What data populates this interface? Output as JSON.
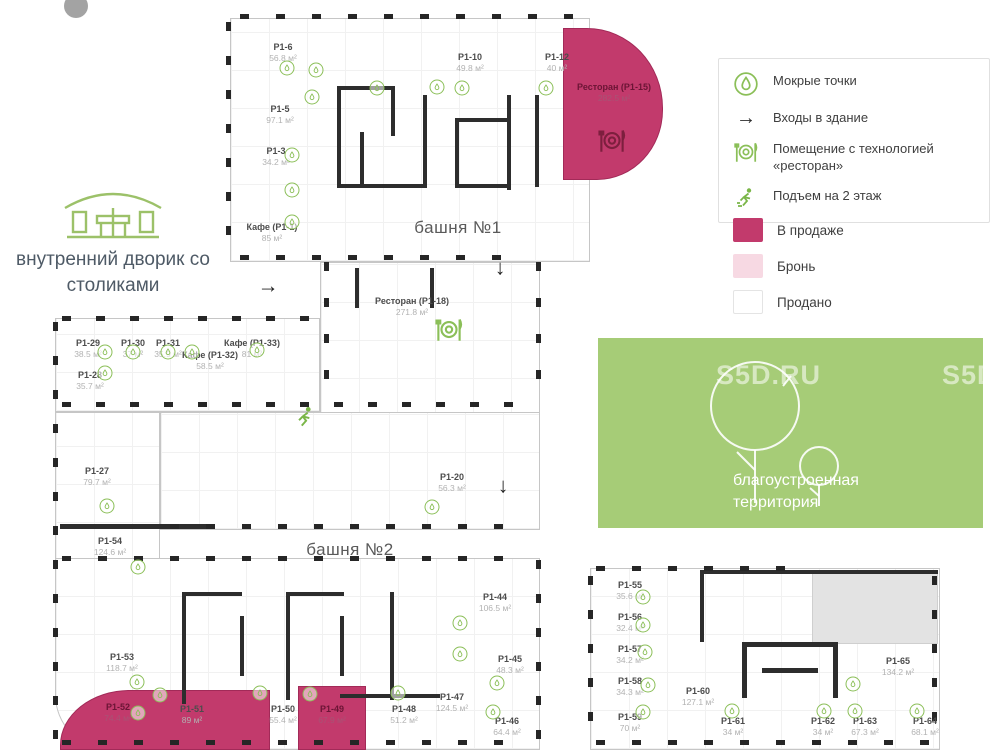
{
  "legend": {
    "items": [
      {
        "icon": "wet-point-icon",
        "label": "Мокрые точки"
      },
      {
        "icon": "entrance-arrow-icon",
        "label": "Входы в здание"
      },
      {
        "icon": "restaurant-icon",
        "label": "Помещение с технологией «ресторан»"
      },
      {
        "icon": "stairs-runner-icon",
        "label": "Подъем на 2 этаж"
      }
    ],
    "statuses": [
      {
        "label": "В продаже",
        "color": "#c23a6c"
      },
      {
        "label": "Бронь",
        "color": "#f7d9e3"
      },
      {
        "label": "Продано",
        "color": "#ffffff"
      }
    ]
  },
  "plan": {
    "tower1_label": "башня №1",
    "tower2_label": "башня №2",
    "courtyard_label": "внутренний дворик со столиками",
    "green_area_label": "благоустроенная территория",
    "watermark": "S5D.RU",
    "accent_green": "#8bbf58",
    "rooms": [
      {
        "name": "P1-6",
        "area": "56.8 м²",
        "x": 283,
        "y": 42
      },
      {
        "name": "P1-5",
        "area": "97.1 м²",
        "x": 280,
        "y": 104
      },
      {
        "name": "P1-3",
        "area": "34.2 м²",
        "x": 276,
        "y": 146
      },
      {
        "name": "Кафе (P1-1)",
        "area": "85 м²",
        "x": 272,
        "y": 222
      },
      {
        "name": "P1-10",
        "area": "49.8 м²",
        "x": 470,
        "y": 52
      },
      {
        "name": "P1-12",
        "area": "40 м²",
        "x": 557,
        "y": 52
      },
      {
        "name": "Ресторан (P1-15)",
        "area": "282.5 м²",
        "x": 614,
        "y": 82,
        "status": "sale"
      },
      {
        "name": "Ресторан (P1-18)",
        "area": "271.8 м²",
        "x": 412,
        "y": 296
      },
      {
        "name": "P1-29",
        "area": "38.5 м²",
        "x": 88,
        "y": 338
      },
      {
        "name": "P1-30",
        "area": "37 м²",
        "x": 133,
        "y": 338
      },
      {
        "name": "P1-31",
        "area": "35.9 м²",
        "x": 168,
        "y": 338
      },
      {
        "name": "Кафе (P1-32)",
        "area": "58.5 м²",
        "x": 210,
        "y": 350
      },
      {
        "name": "Кафе (P1-33)",
        "area": "81 м²",
        "x": 252,
        "y": 338
      },
      {
        "name": "P1-28",
        "area": "35.7 м²",
        "x": 90,
        "y": 370
      },
      {
        "name": "P1-27",
        "area": "79.7 м²",
        "x": 97,
        "y": 466
      },
      {
        "name": "P1-20",
        "area": "56.3 м²",
        "x": 452,
        "y": 472
      },
      {
        "name": "P1-54",
        "area": "124.6 м²",
        "x": 110,
        "y": 536
      },
      {
        "name": "P1-53",
        "area": "118.7 м²",
        "x": 122,
        "y": 652
      },
      {
        "name": "P1-52",
        "area": "74.4 м²",
        "x": 118,
        "y": 702,
        "status": "sale"
      },
      {
        "name": "P1-51",
        "area": "89 м²",
        "x": 192,
        "y": 704
      },
      {
        "name": "P1-50",
        "area": "55.4 м²",
        "x": 283,
        "y": 704
      },
      {
        "name": "P1-49",
        "area": "67.9 м²",
        "x": 332,
        "y": 704,
        "status": "sale"
      },
      {
        "name": "P1-48",
        "area": "51.2 м²",
        "x": 404,
        "y": 704
      },
      {
        "name": "P1-47",
        "area": "124.5 м²",
        "x": 452,
        "y": 692
      },
      {
        "name": "P1-46",
        "area": "64.4 м²",
        "x": 507,
        "y": 716
      },
      {
        "name": "P1-45",
        "area": "48.3 м²",
        "x": 510,
        "y": 654
      },
      {
        "name": "P1-44",
        "area": "106.5 м²",
        "x": 495,
        "y": 592
      },
      {
        "name": "P1-55",
        "area": "35.6 м²",
        "x": 630,
        "y": 580
      },
      {
        "name": "P1-56",
        "area": "32.4 м²",
        "x": 630,
        "y": 612
      },
      {
        "name": "P1-57",
        "area": "34.2 м²",
        "x": 630,
        "y": 644
      },
      {
        "name": "P1-58",
        "area": "34.3 м²",
        "x": 630,
        "y": 676
      },
      {
        "name": "P1-59",
        "area": "70 м²",
        "x": 630,
        "y": 712
      },
      {
        "name": "P1-60",
        "area": "127.1 м²",
        "x": 698,
        "y": 686
      },
      {
        "name": "P1-61",
        "area": "34 м²",
        "x": 733,
        "y": 716
      },
      {
        "name": "P1-62",
        "area": "34 м²",
        "x": 823,
        "y": 716
      },
      {
        "name": "P1-63",
        "area": "67.3 м²",
        "x": 865,
        "y": 716
      },
      {
        "name": "P1-64",
        "area": "68.1 м²",
        "x": 925,
        "y": 716
      },
      {
        "name": "P1-65",
        "area": "134.2 м²",
        "x": 898,
        "y": 656
      }
    ],
    "wet_points": [
      [
        287,
        68
      ],
      [
        316,
        70
      ],
      [
        312,
        97
      ],
      [
        292,
        155
      ],
      [
        292,
        190
      ],
      [
        292,
        222
      ],
      [
        377,
        88
      ],
      [
        437,
        87
      ],
      [
        462,
        88
      ],
      [
        546,
        88
      ],
      [
        105,
        352
      ],
      [
        133,
        352
      ],
      [
        168,
        352
      ],
      [
        192,
        352
      ],
      [
        257,
        350
      ],
      [
        105,
        373
      ],
      [
        107,
        506
      ],
      [
        432,
        507
      ],
      [
        138,
        567
      ],
      [
        137,
        682
      ],
      [
        160,
        695
      ],
      [
        138,
        713
      ],
      [
        260,
        693
      ],
      [
        310,
        694
      ],
      [
        398,
        693
      ],
      [
        460,
        623
      ],
      [
        460,
        654
      ],
      [
        497,
        683
      ],
      [
        493,
        712
      ],
      [
        643,
        597
      ],
      [
        643,
        625
      ],
      [
        645,
        652
      ],
      [
        648,
        685
      ],
      [
        643,
        712
      ],
      [
        732,
        711
      ],
      [
        824,
        711
      ],
      [
        855,
        711
      ],
      [
        917,
        711
      ],
      [
        853,
        684
      ]
    ],
    "restaurant_icons": [
      {
        "x": 449,
        "y": 332,
        "variant": "green"
      },
      {
        "x": 612,
        "y": 143,
        "variant": "dark"
      }
    ],
    "runner_icons": [
      {
        "x": 305,
        "y": 420
      }
    ],
    "arrows": [
      {
        "x": 268,
        "y": 286,
        "dir": "right"
      },
      {
        "x": 500,
        "y": 268,
        "dir": "down"
      },
      {
        "x": 503,
        "y": 486,
        "dir": "down"
      }
    ]
  }
}
